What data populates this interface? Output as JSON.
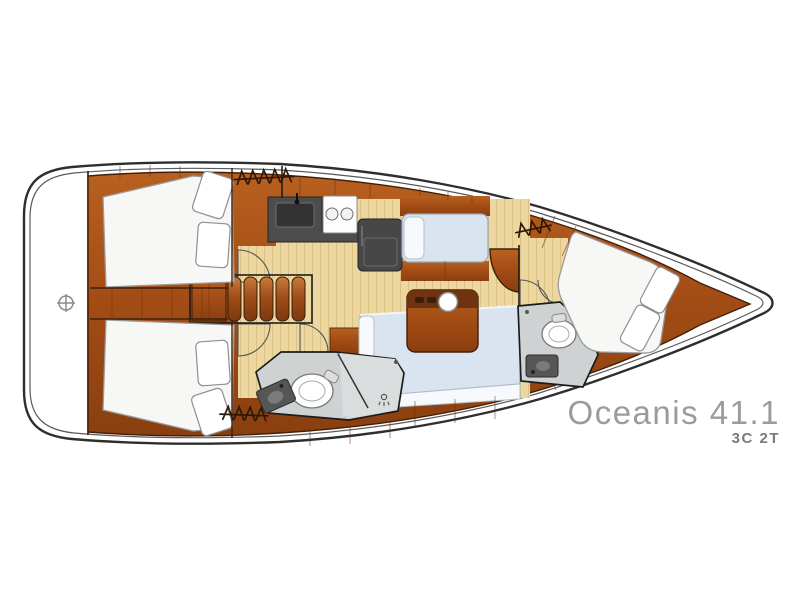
{
  "branding": {
    "model_name": "Oceanis 41.1",
    "layout_code": "3C 2T"
  },
  "icons": {
    "hanger-icon": "zigzag clothes-hanger row (wardrobe locker symbol)",
    "capstan-icon": "circle with cross (deck fitting on transom)",
    "shower-drain-icon": "small circle with spray lines",
    "stove-burner-icon": "two circles on white cooktop",
    "toilet-icon": "oval bowl with tank",
    "sink-icon": "dark basin with faucet dot"
  },
  "colors": {
    "background": "#ffffff",
    "hull-line": "#2e2e2e",
    "inner-line": "#5a5a5a",
    "outline-dark": "#40200a",
    "wood": "#a8521e",
    "wood-dark": "#6b3310",
    "floor": "#ecd7a0",
    "floor-stripe": "#dcc184",
    "upholstery": "#d9e4f0",
    "cushion": "#f7fafc",
    "bed": "#f7f7f6",
    "bath-floor": "#cfd2d2",
    "bath-shower": "#dadddd",
    "counter": "#4d4d4d",
    "appliance": "#474747",
    "title-text": "#9b9b9b",
    "subtitle-text": "#7a7a7a"
  }
}
